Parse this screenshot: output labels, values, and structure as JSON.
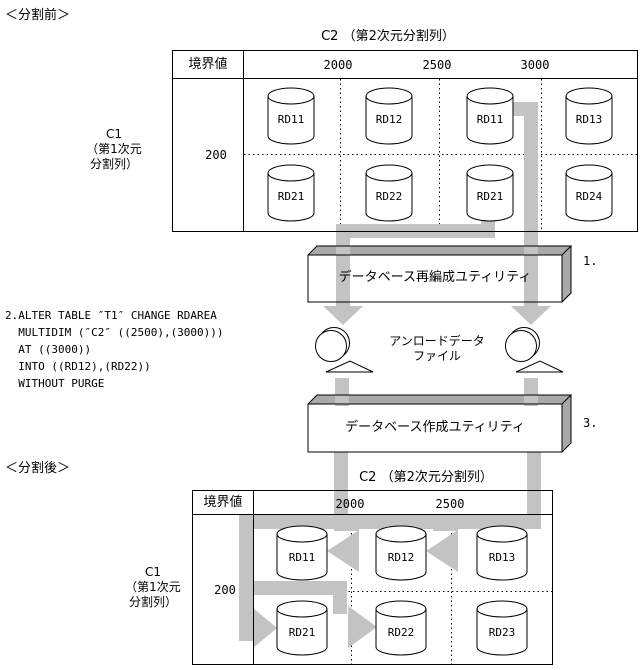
{
  "colors": {
    "arrow_gray": "#c3c3c3",
    "box_face_gray": "#a9a9a9",
    "line_black": "#000000",
    "background": "#ffffff"
  },
  "before": {
    "section_label": "＜分割前＞",
    "c2_axis_label": "C2 （第2次元分割列）",
    "c1_axis_label_lines": [
      "C1",
      "（第1次元",
      "分割列）"
    ],
    "boundary_header": "境界値",
    "boundary_values": [
      "2000",
      "2500",
      "3000"
    ],
    "row_boundary_value": "200",
    "row1_rdareas": [
      "RD11",
      "RD12",
      "RD11",
      "RD13"
    ],
    "row2_rdareas": [
      "RD21",
      "RD22",
      "RD21",
      "RD24"
    ]
  },
  "process": {
    "step1_label": "1.",
    "reorg_utility_label": "データベース再編成ユティリティ",
    "sql_lines": [
      "2.ALTER TABLE ″T1″ CHANGE RDAREA",
      "  MULTIDIM (″C2″ ((2500),(3000)))",
      "  AT ((3000))",
      "  INTO ((RD12),(RD22))",
      "  WITHOUT PURGE"
    ],
    "unload_file_label_lines": [
      "アンロードデータ",
      "ファイル"
    ],
    "create_utility_label": "データベース作成ユティリティ",
    "step3_label": "3."
  },
  "after": {
    "section_label": "＜分割後＞",
    "c2_axis_label": "C2 （第2次元分割列）",
    "c1_axis_label_lines": [
      "C1",
      "（第1次元",
      "分割列）"
    ],
    "boundary_header": "境界値",
    "boundary_values": [
      "2000",
      "2500"
    ],
    "row_boundary_value": "200",
    "row1_rdareas": [
      "RD11",
      "RD12",
      "RD13"
    ],
    "row2_rdareas": [
      "RD21",
      "RD22",
      "RD23"
    ]
  }
}
